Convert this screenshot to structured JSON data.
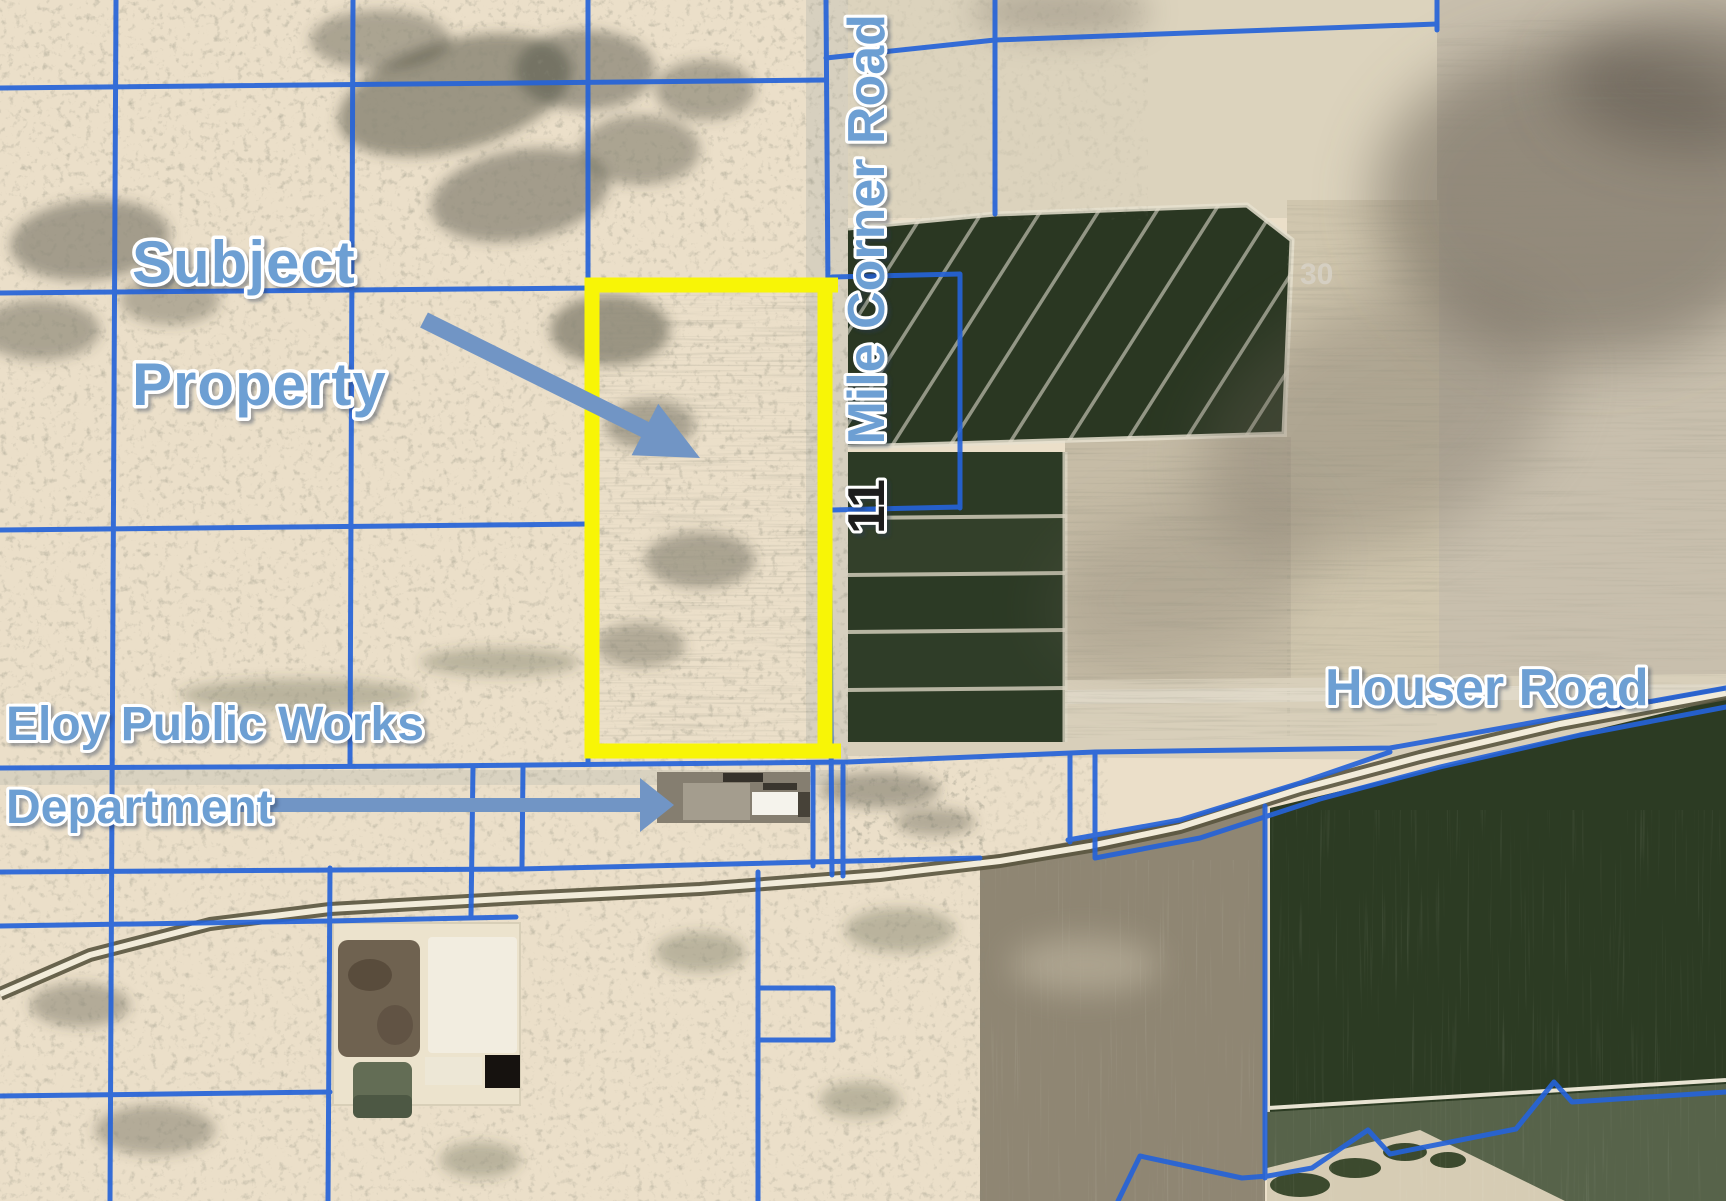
{
  "map": {
    "labels": {
      "subject_line1": "Subject",
      "subject_line2": "Property",
      "public_works_line1": "Eloy Public Works",
      "public_works_line2": "Department",
      "houser_road": "Houser Road",
      "corner_road_number": "11",
      "corner_road_name": "Mile Corner Road",
      "section_number": "30"
    },
    "colors": {
      "label_blue": "#6d9fd3",
      "label_outline": "#ffffff",
      "parcel_blue": "#2563d8",
      "highlight_yellow": "#f8f506",
      "arrow_blue": "#7195c5",
      "road_number_black": "#1a1a1a",
      "section_number_gray": "#d6d1c5"
    }
  }
}
